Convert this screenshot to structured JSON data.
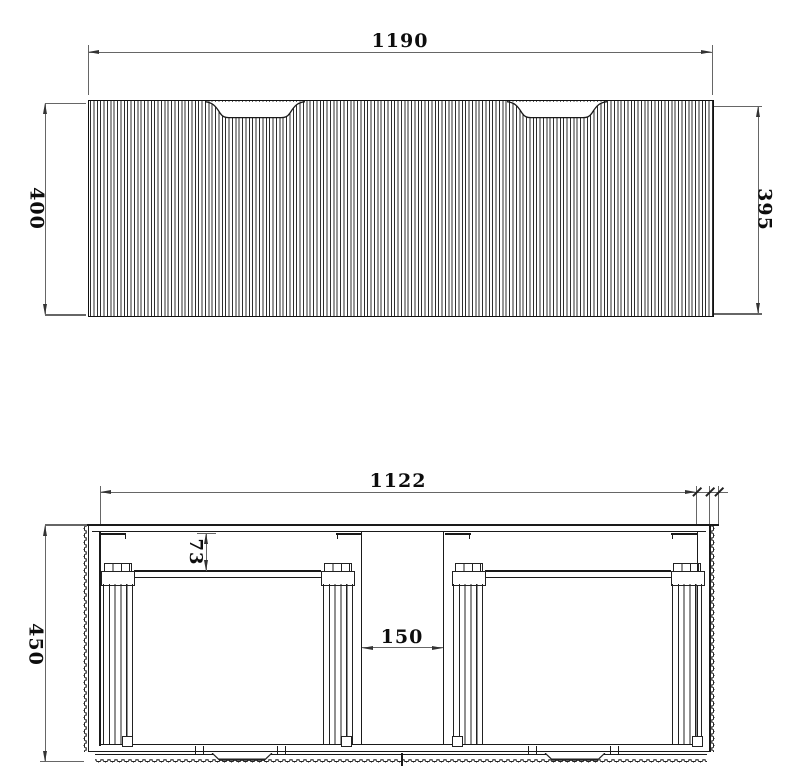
{
  "drawing": {
    "front_view": {
      "width_label": "1190",
      "height_left_label": "400",
      "height_right_label": "395"
    },
    "section_view": {
      "inner_width_label": "1122",
      "depth_label": "450",
      "back_clearance_label": "73",
      "center_gap_label": "150"
    }
  }
}
